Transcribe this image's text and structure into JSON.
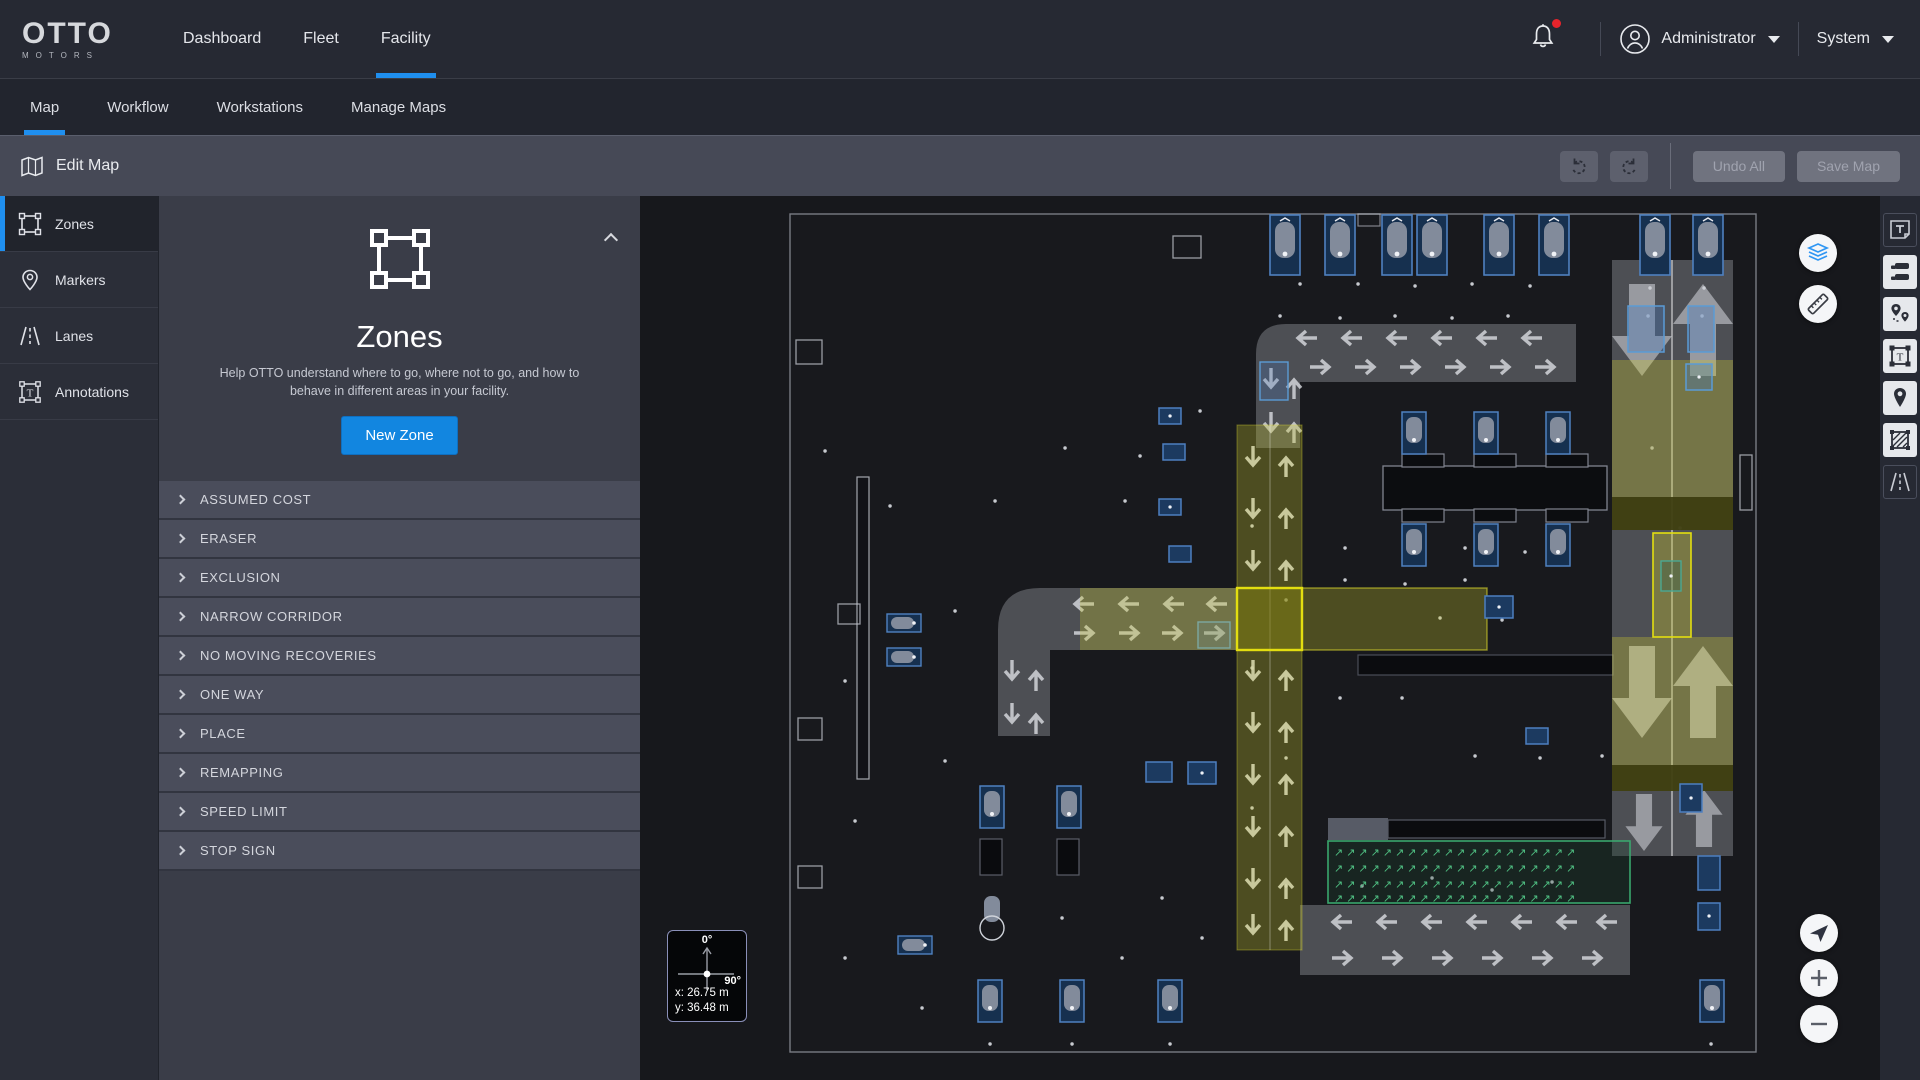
{
  "header": {
    "logo": {
      "brand": "OTTO",
      "sub": "MOTORS"
    },
    "nav": [
      {
        "label": "Dashboard",
        "active": false
      },
      {
        "label": "Fleet",
        "active": false
      },
      {
        "label": "Facility",
        "active": true
      }
    ],
    "notifications": {
      "unread_indicator": true
    },
    "user": {
      "name": "Administrator"
    },
    "system": {
      "label": "System"
    }
  },
  "subnav": {
    "tabs": [
      {
        "label": "Map",
        "active": true
      },
      {
        "label": "Workflow",
        "active": false
      },
      {
        "label": "Workstations",
        "active": false
      },
      {
        "label": "Manage Maps",
        "active": false
      }
    ]
  },
  "toolbar": {
    "title": "Edit Map",
    "undo_all_label": "Undo All",
    "save_map_label": "Save Map"
  },
  "sidebar": {
    "items": [
      {
        "label": "Zones",
        "active": true
      },
      {
        "label": "Markers",
        "active": false
      },
      {
        "label": "Lanes",
        "active": false
      },
      {
        "label": "Annotations",
        "active": false
      }
    ]
  },
  "zones_panel": {
    "title": "Zones",
    "description": "Help OTTO understand where to go, where not to go, and how to behave in different areas in your facility.",
    "new_zone_label": "New Zone",
    "zone_types": [
      "ASSUMED COST",
      "ERASER",
      "EXCLUSION",
      "NARROW CORRIDOR",
      "NO MOVING RECOVERIES",
      "ONE WAY",
      "PLACE",
      "REMAPPING",
      "SPEED LIMIT",
      "STOP SIGN"
    ]
  },
  "map": {
    "compass": {
      "top_label": "0°",
      "right_label": "90°",
      "x_label": "x: 26.75 m",
      "y_label": "y: 36.48 m"
    },
    "right_toolbar_tools": [
      "text-note",
      "fleet-robots",
      "markers-pair",
      "annotation-frame",
      "marker",
      "zone-hatch",
      "lanes"
    ],
    "overlay_controls": [
      "layers",
      "measure",
      "locate",
      "zoom-in",
      "zoom-out"
    ]
  },
  "colors": {
    "accent_blue": "#1f8fef",
    "button_blue": "#1286e0",
    "zone_yellow": "#d8d421",
    "zone_green": "#3aa76d",
    "alert_red": "#e8242c"
  }
}
